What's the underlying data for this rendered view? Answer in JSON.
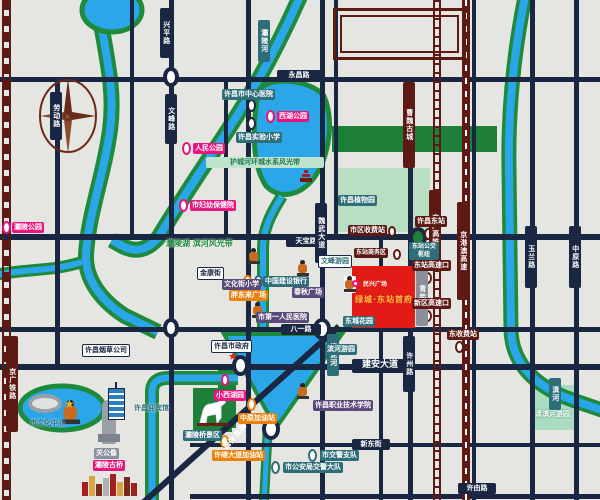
{
  "map": {
    "city": "许昌",
    "colors": {
      "background": "#e5e5e1",
      "road": "#1a2742",
      "river_blue": "#2ba6e8",
      "river_bank_green": "#1e8a3c",
      "rail_maroon": "#5d1a14",
      "park_green": "#1e7f38",
      "park_mint": "#aadcc1",
      "project_red": "#e31b17",
      "project_gold": "#f5c13d",
      "pink": "#e8157f",
      "teal": "#2e6e78",
      "purple": "#5a4a7a",
      "orange": "#e8820c"
    },
    "roads_h": [
      "永昌路",
      "天宝路",
      "八一路",
      "建安大道",
      "新东街",
      "许由路"
    ],
    "roads_v": [
      "劳动路",
      "兴平路",
      "文峰路",
      "魏武大道",
      "许州路",
      "玉兰路",
      "中原路",
      "青年路",
      "莲城大道"
    ],
    "rails": [
      "京广铁路",
      "京广高铁",
      "京港澳高速"
    ],
    "rivers": [
      "灞陵河",
      "清泥河",
      "潩河"
    ],
    "heritage": {
      "wall": "曹魏古城"
    },
    "stations": [
      "许昌东站",
      "东站公交枢纽",
      "东站高速口",
      "新区高速口",
      "东收费站",
      "市区收费站",
      "东站商务区"
    ],
    "parks": [
      "西湖公园",
      "人民公园",
      "灞陵公园",
      "小西湖园",
      "许昌植物园",
      "清潩河游园",
      "滨河游园",
      "文峰游园",
      "护城河环城水系风光带",
      "灞陵湖 滨河风光带"
    ],
    "pois": [
      "许昌市中心医院",
      "许昌实验小学",
      "市妇幼保健院",
      "中国建设银行",
      "文化街小学",
      "春秋广场",
      "市第一人民医院",
      "胖东来广场",
      "中原加油站",
      "许继大道加油站",
      "东城花园",
      "市交警支队",
      "市公安局交警大队",
      "许昌职业技术学院",
      "许昌市政府",
      "金康街",
      "许昌烟草公司",
      "许昌迎宾馆",
      "市文化中心",
      "灞陵桥景区",
      "关公像",
      "灞陵古桥"
    ],
    "project": {
      "name": "绿城·东站首府",
      "sub": "民兴广场"
    }
  }
}
